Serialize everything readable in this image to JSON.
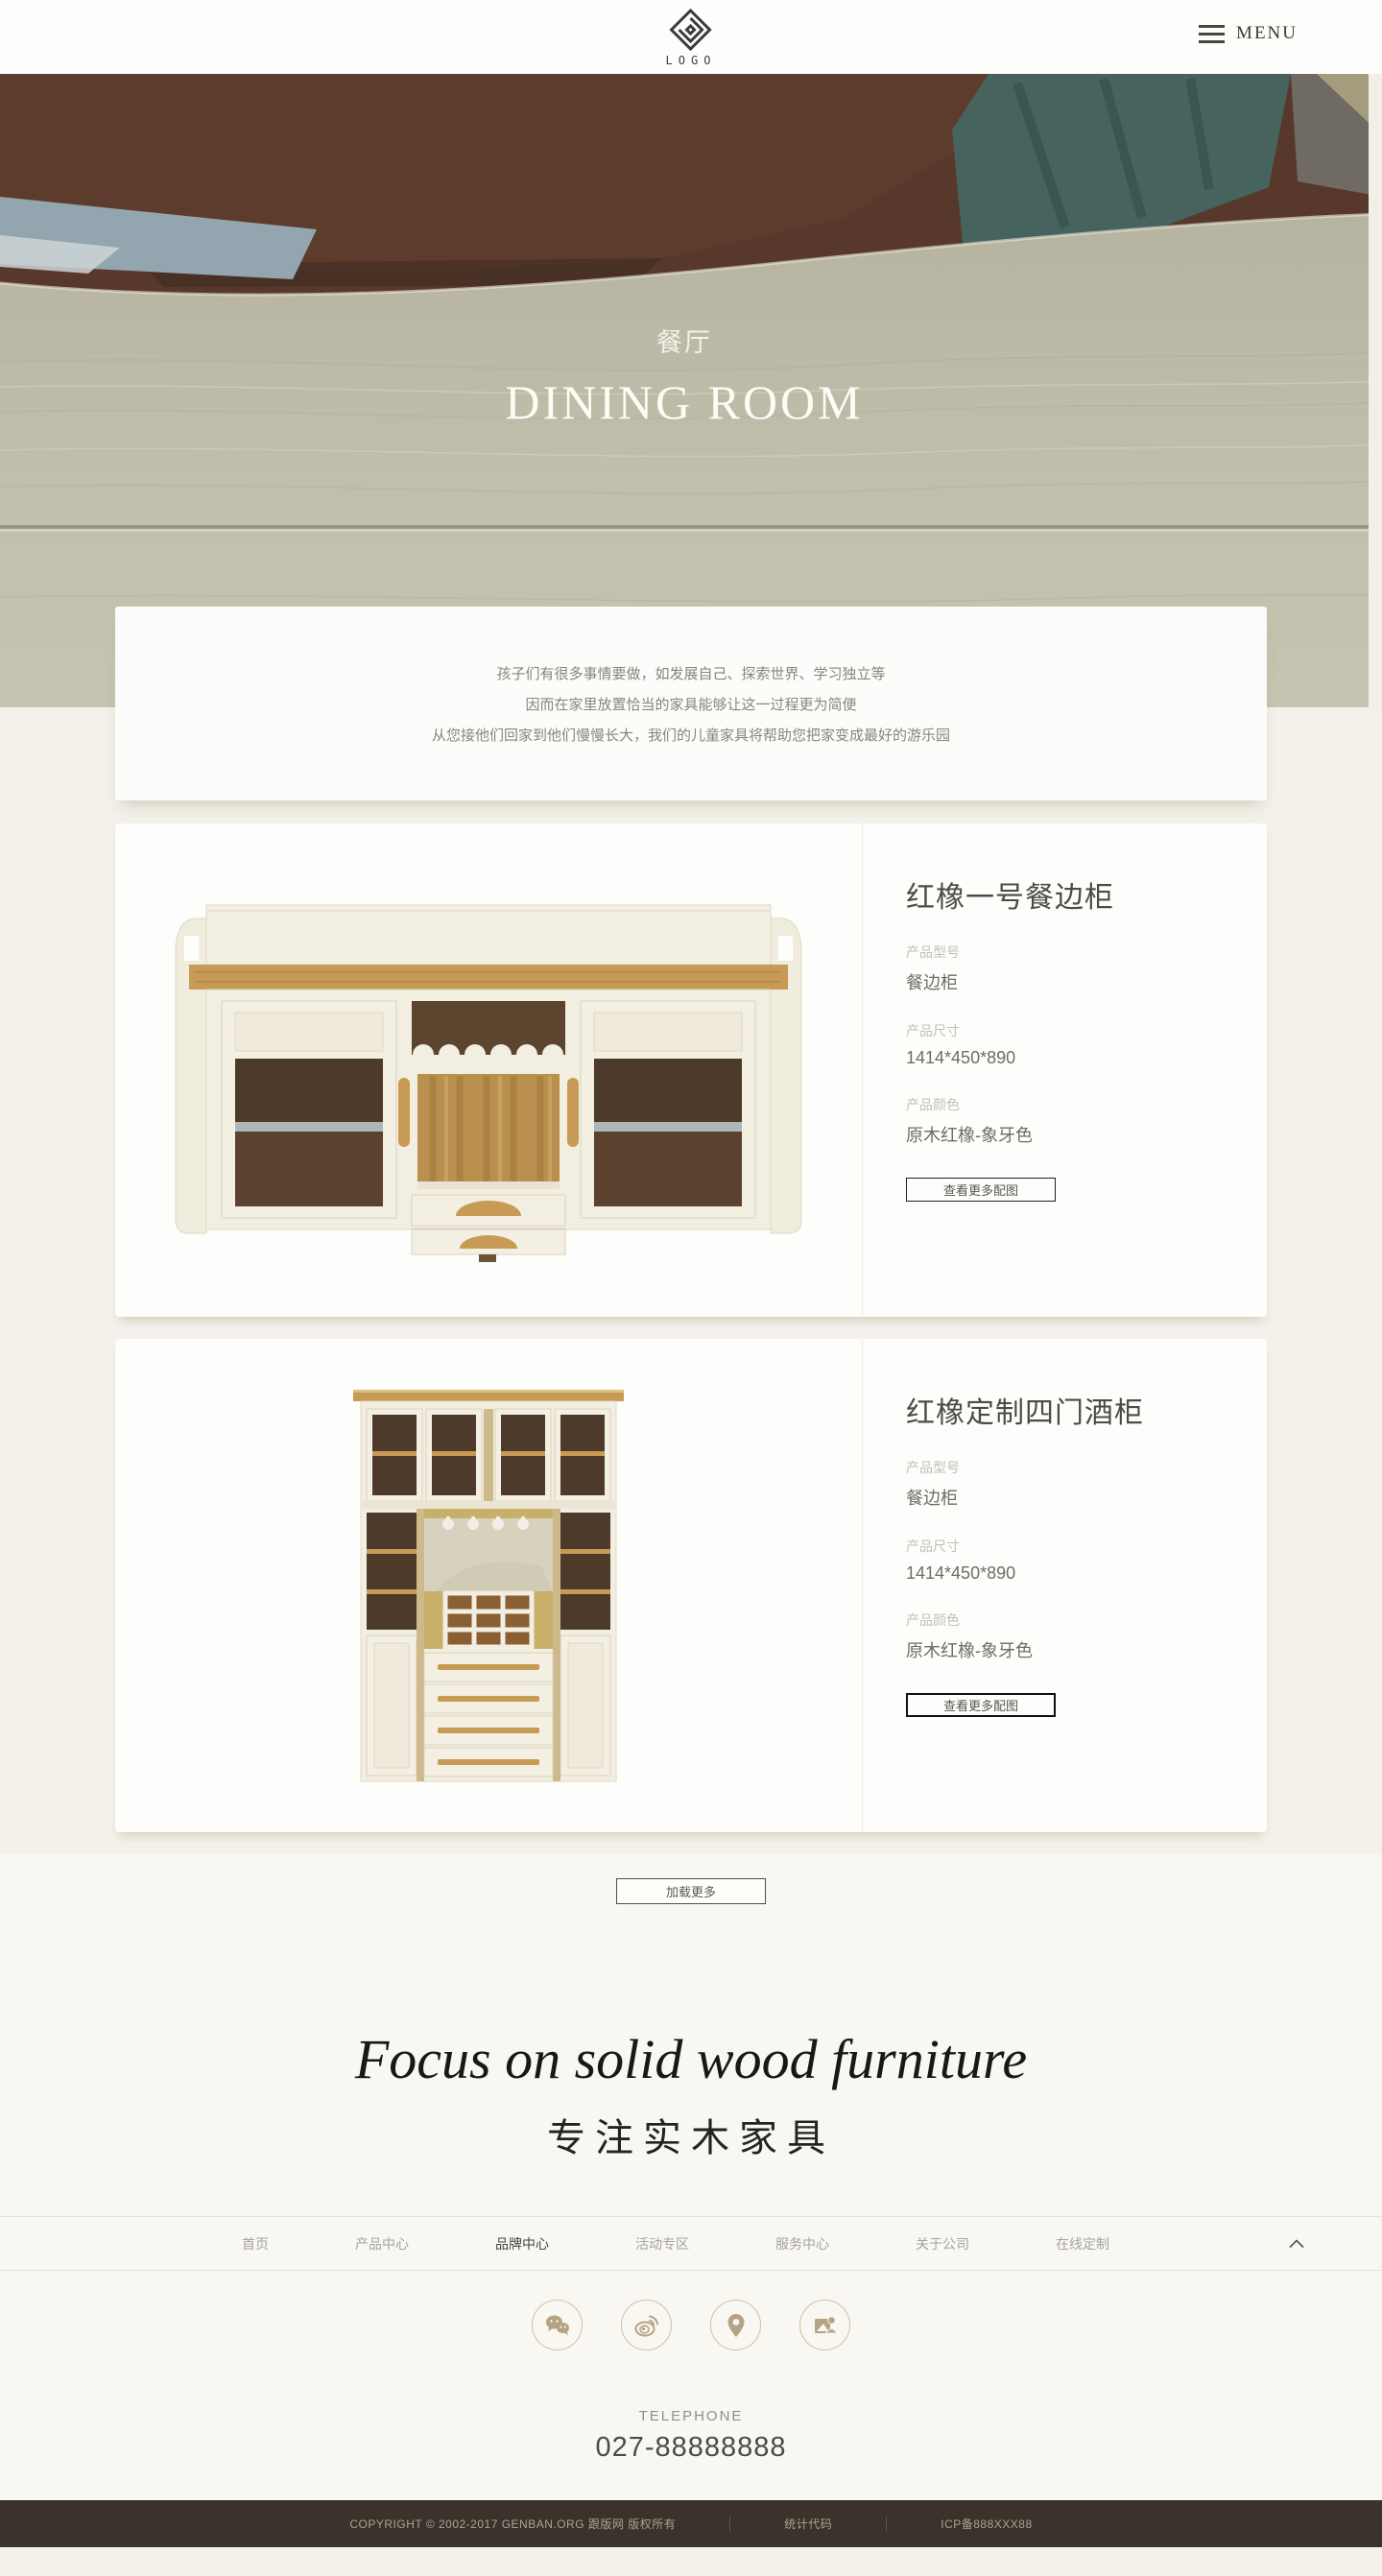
{
  "header": {
    "logo_text": "LOGO",
    "menu_label": "MENU"
  },
  "hero": {
    "title_cn": "餐厅",
    "title_en": "DINING ROOM"
  },
  "intro": {
    "lines": [
      "孩子们有很多事情要做，如发展自己、探索世界、学习独立等",
      "因而在家里放置恰当的家具能够让这一过程更为简便",
      "从您接他们回家到他们慢慢长大，我们的儿童家具将帮助您把家变成最好的游乐园"
    ]
  },
  "products": [
    {
      "title": "红橡一号餐边柜",
      "model_label": "产品型号",
      "model": "餐边柜",
      "size_label": "产品尺寸",
      "size": "1414*450*890",
      "color_label": "产品颜色",
      "color": "原木红橡-象牙色",
      "more_label": "查看更多配图"
    },
    {
      "title": "红橡定制四门酒柜",
      "model_label": "产品型号",
      "model": "餐边柜",
      "size_label": "产品尺寸",
      "size": "1414*450*890",
      "color_label": "产品颜色",
      "color": "原木红橡-象牙色",
      "more_label": "查看更多配图"
    }
  ],
  "load_more_label": "加载更多",
  "slogan": {
    "en": "Focus on solid wood furniture",
    "cn": "专注实木家具"
  },
  "footer_nav": {
    "items": [
      {
        "label": "首页"
      },
      {
        "label": "产品中心"
      },
      {
        "label": "品牌中心"
      },
      {
        "label": "活动专区"
      },
      {
        "label": "服务中心"
      },
      {
        "label": "关于公司"
      },
      {
        "label": "在线定制"
      }
    ],
    "active_label": "品牌中心"
  },
  "social": {
    "items": [
      "wechat",
      "weibo",
      "location",
      "contact"
    ]
  },
  "contact": {
    "label": "TELEPHONE",
    "phone": "027-88888888"
  },
  "footer": {
    "copyright": "COPYRIGHT © 2002-2017 GENBAN.ORG 跟版网 版权所有",
    "stat_label": "统计代码",
    "icp": "ICP备888XXX88"
  },
  "colors": {
    "accent_tan": "#b5a384",
    "footer_bg": "#3a322b",
    "page_bg": "#f3f1ea",
    "hero_wood": "#c1beac",
    "oak": "#c79a55"
  }
}
